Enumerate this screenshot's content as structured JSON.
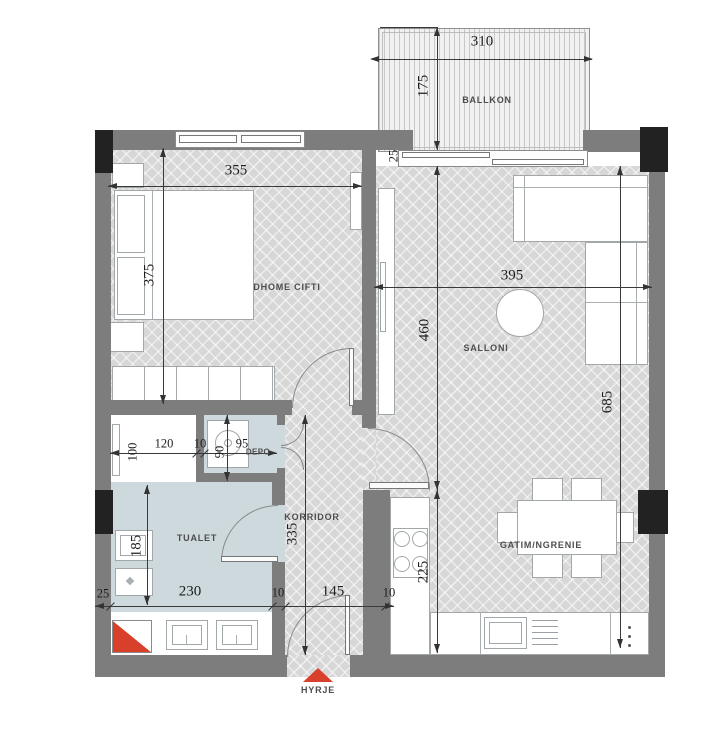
{
  "labels": {
    "ballkon": "BALLKON",
    "dhome_cifti": "DHOME CIFTI",
    "salloni": "SALLONI",
    "gatim_ngrenie": "GATIM/NGRENIE",
    "korridor": "KORRIDOR",
    "tualet": "TUALET",
    "depo": "DEPO",
    "hyrje": "HYRJE"
  },
  "dims": {
    "balcony_width": "310",
    "balcony_depth": "175",
    "balcony_offset": "25",
    "bedroom_width": "355",
    "bedroom_depth": "375",
    "salloni_width": "395",
    "salloni_depth": "460",
    "salloni_total_depth": "685",
    "bath_depth": "100",
    "bath_width": "120",
    "bath_gap": "10",
    "depo_depth": "90",
    "depo_width": "95",
    "tualet_depth": "185",
    "tualet_width": "230",
    "korridor_depth": "335",
    "korridor_width": "145",
    "kitchen_depth": "225",
    "bottom_left": "25",
    "bottom_gap1": "10",
    "bottom_gap2": "10"
  },
  "colors": {
    "wall": "#7d7d7d",
    "column": "#222222",
    "wet_floor": "#cdd9dd",
    "floor": "#d7d7d7",
    "entry_red": "#d8402c",
    "line": "#3a3a3a"
  }
}
